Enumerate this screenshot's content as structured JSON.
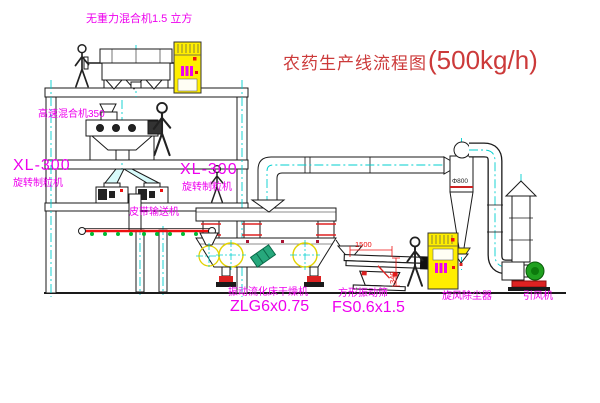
{
  "title": {
    "name": "农药生产线流程图",
    "capacity": "(500kg/h)"
  },
  "equipment": {
    "gravity_mixer": {
      "label": "无重力混合机1.5 立方"
    },
    "high_speed_mixer": {
      "label": "高速混合机350"
    },
    "granulator_left": {
      "model": "XL-300",
      "name": "旋转制粒机"
    },
    "granulator_right": {
      "model": "XL-300",
      "name": "旋转制粒机"
    },
    "belt_conveyor": {
      "label": "皮带输送机"
    },
    "fluid_bed_dryer": {
      "name": "振动流化床干燥机",
      "model": "ZLG6x0.75"
    },
    "vibrating_screen": {
      "name": "方形振动筛",
      "model": "FS0.6x1.5",
      "dim_length": "1500",
      "dim_height": "340"
    },
    "cyclone": {
      "label": "旋风除尘器",
      "diameter": "Φ800"
    },
    "induced_fan": {
      "label": "引风机"
    }
  },
  "colors": {
    "background": "#ffffff",
    "line": "#1a1a1a",
    "centerline": "#00cfcf",
    "label_magenta": "#ee00ee",
    "title_red": "#cc3a3a",
    "dimension_red": "#ee1111",
    "cabinet_yellow": "#ffee00",
    "conveyor_red": "#ee1111",
    "fan_green": "#1fa01f",
    "highlight_yellow": "#e3d200"
  }
}
